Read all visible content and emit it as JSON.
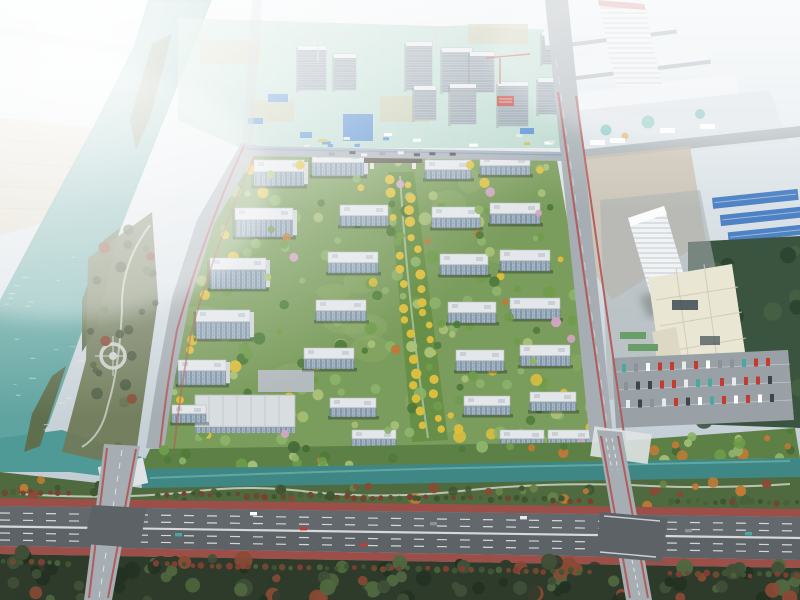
{
  "scene": {
    "type": "aerial-rendering-photo",
    "regions": [
      "river",
      "riverside-park",
      "farmland",
      "hazy-city",
      "construction-zone",
      "white-building-complex",
      "hospital-complex",
      "warehouses",
      "parking-lot",
      "residential-site",
      "central-green-axis",
      "entrance-gate",
      "commercial-strip",
      "canal",
      "riverside-green-strip",
      "highway",
      "forest-belt",
      "boundary-roads"
    ]
  },
  "palette": {
    "sky_top": "#eef3f5",
    "sky_bottom": "#b7c3cc",
    "river": "#68a8a4",
    "river_deep": "#4f9a96",
    "canal": "#3f8785",
    "farmland": "#d9d0bb",
    "park": "#6f7a58",
    "island": "#5f6f4e",
    "construction_ground": "#a9d2c3",
    "construction_building": "#b4bfc8",
    "construction_blue": "#4a86cc",
    "banner_red": "#bb3b30",
    "white_complex": "#eef2f4",
    "plaza": "#dce3e7",
    "hospital_tower": "#f0f2f3",
    "hospital_podium": "#eae6d4",
    "warehouse_blue": "#4e82c4",
    "dark_trees": "#3a5440",
    "parking": "#9aa1a6",
    "road": "#a6aeb3",
    "road_red": "#b25555",
    "site_green": "#7a9c5c",
    "axis_green": "#688f47",
    "bank_green": "#5d8046",
    "roof": "#e3e7ea",
    "facade": "#a7b8c6",
    "facade_line": "#5d7488",
    "gate": "#57504a",
    "commercial_roof": "#d8dde0",
    "highway": "#5d6266",
    "highway_red": "#9c4f49",
    "lane": "#e8ecee",
    "forest": "#2e3b2b",
    "tree_greens": [
      "#4e7a3a",
      "#6f9c4a",
      "#8db36a",
      "#a9c178"
    ],
    "tree_yellow": "#dcbe3e",
    "tree_orange": "#c07a36",
    "tree_autumn": "#8a4a35",
    "tree_pink": "#d3a6c6",
    "car_colors": [
      "#ffffff",
      "#e8eaec",
      "#3f454b",
      "#8b9298",
      "#c43c30",
      "#4aa8a0"
    ]
  }
}
